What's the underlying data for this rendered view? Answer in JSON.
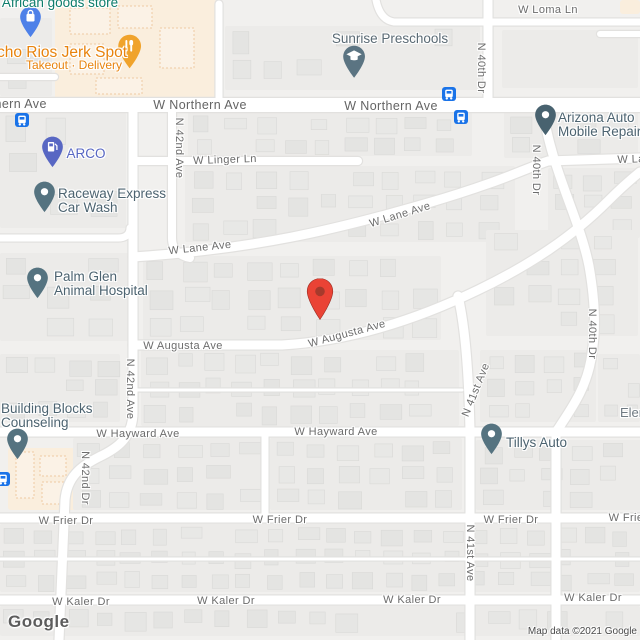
{
  "map": {
    "logo_text": "Google",
    "attribution": "Map data ©2021 Google",
    "colors": {
      "background": "#F1F0EE",
      "road": "#FFFFFF",
      "building": "#E6E6E4",
      "commercial_area": "#FAEEDD",
      "street_text": "#6C6C6C",
      "generic_poi_text": "#4C6370",
      "food_poi_text": "#E8830D",
      "shopping_poi_text": "#0E7D6B",
      "gas_poi_text": "#5867C3",
      "transit_blue": "#1A73E8",
      "marker_red": "#EA4335"
    },
    "marker": {
      "x": 320,
      "y": 299,
      "color": "#EA4335",
      "dot_color": "#A63A2C"
    },
    "transit_stops": [
      {
        "x": 22,
        "y": 120
      },
      {
        "x": 449,
        "y": 94
      },
      {
        "x": 461,
        "y": 117
      },
      {
        "x": 3,
        "y": 479
      }
    ],
    "street_labels": [
      {
        "text": "W Loma Ln",
        "x": 548,
        "y": 10
      },
      {
        "text": "W Northern Ave",
        "x": 0,
        "y": 104,
        "major": true
      },
      {
        "text": "W Northern Ave",
        "x": 200,
        "y": 105,
        "major": true
      },
      {
        "text": "W Northern Ave",
        "x": 391,
        "y": 106,
        "major": true
      },
      {
        "text": "W Linger Ln",
        "x": 225,
        "y": 160,
        "rot": -2
      },
      {
        "text": "W Lane Ave",
        "x": 200,
        "y": 248,
        "rot": -6
      },
      {
        "text": "W Lane Ave",
        "x": 400,
        "y": 215,
        "rot": -17
      },
      {
        "text": "W Lane Ave",
        "x": 649,
        "y": 159,
        "rot": -2
      },
      {
        "text": "W Augusta Ave",
        "x": 183,
        "y": 346
      },
      {
        "text": "W Augusta Ave",
        "x": 347,
        "y": 334,
        "rot": -15
      },
      {
        "text": "W Hayward Ave",
        "x": 138,
        "y": 434
      },
      {
        "text": "W Hayward Ave",
        "x": 336,
        "y": 432
      },
      {
        "text": "W Frier Dr",
        "x": 66,
        "y": 521
      },
      {
        "text": "W Frier Dr",
        "x": 280,
        "y": 520
      },
      {
        "text": "W Frier Dr",
        "x": 511,
        "y": 520
      },
      {
        "text": "W Frier Dr",
        "x": 636,
        "y": 518
      },
      {
        "text": "W Kaler Dr",
        "x": 81,
        "y": 602
      },
      {
        "text": "W Kaler Dr",
        "x": 226,
        "y": 601
      },
      {
        "text": "W Kaler Dr",
        "x": 412,
        "y": 600
      },
      {
        "text": "W Kaler Dr",
        "x": 593,
        "y": 598
      },
      {
        "text": "N 42nd Ave",
        "x": 179,
        "y": 148,
        "vert": true
      },
      {
        "text": "N 42nd Ave",
        "x": 130,
        "y": 389,
        "vert": true
      },
      {
        "text": "N 42nd Dr",
        "x": 85,
        "y": 478,
        "vert": true
      },
      {
        "text": "N 40th Dr",
        "x": 481,
        "y": 68,
        "vert": true
      },
      {
        "text": "N 40th Dr",
        "x": 536,
        "y": 170,
        "vert": true
      },
      {
        "text": "N 40th Dr",
        "x": 592,
        "y": 334,
        "vert": true
      },
      {
        "text": "N 41st Ave",
        "x": 476,
        "y": 390,
        "rot": -68
      },
      {
        "text": "N 41st Ave",
        "x": 470,
        "y": 553,
        "vert": true
      }
    ],
    "pois": [
      {
        "id": "african-goods-store",
        "lines": [
          "African goods store"
        ],
        "x": 60,
        "y": 2,
        "align": "center",
        "color": "#0E7D6B",
        "size": 13.5,
        "pin": {
          "x": 30,
          "y": 22,
          "color": "#4D80E8",
          "glyph": "bag"
        }
      },
      {
        "id": "ocho-rios-jerk-spot",
        "lines": [
          "Ocho Rios Jerk Spot"
        ],
        "x": 56,
        "y": 51,
        "align": "center",
        "color": "#E8830D",
        "size": 15.5,
        "sub": {
          "text": "Takeout · Delivery",
          "x": 74,
          "y": 64,
          "size": 12
        },
        "pin": {
          "x": 130,
          "y": 52,
          "color": "#F0A32C",
          "glyph": "food",
          "s": 1.1
        }
      },
      {
        "id": "sunrise-preschools",
        "lines": [
          "Sunrise Preschools"
        ],
        "x": 390,
        "y": 38,
        "align": "center",
        "color": "#5A6A74",
        "size": 13.5,
        "pin": {
          "x": 354,
          "y": 62,
          "color": "#5B7482",
          "glyph": "cap",
          "s": 1.05
        }
      },
      {
        "id": "arco",
        "lines": [
          "ARCO"
        ],
        "x": 86,
        "y": 153,
        "align": "center",
        "color": "#5867C3",
        "size": 13.5,
        "pin": {
          "x": 52,
          "y": 152,
          "color": "#5867C3",
          "glyph": "gas"
        }
      },
      {
        "id": "raceway-express-car-wash",
        "lines": [
          "Raceway Express",
          "Car Wash"
        ],
        "x": 58,
        "y": 193,
        "align": "left",
        "color": "#4C6370",
        "size": 13.5,
        "pin": {
          "x": 44,
          "y": 197,
          "color": "#557380",
          "glyph": "dot"
        }
      },
      {
        "id": "palm-glen-animal-hospital",
        "lines": [
          "Palm Glen",
          "Animal Hospital"
        ],
        "x": 54,
        "y": 276,
        "align": "left",
        "color": "#4C6370",
        "size": 13.5,
        "pin": {
          "x": 37,
          "y": 283,
          "color": "#557380",
          "glyph": "dot"
        }
      },
      {
        "id": "arizona-auto-mobile-repair",
        "lines": [
          "Arizona Auto",
          "Mobile Repair"
        ],
        "x": 558,
        "y": 117,
        "align": "left",
        "color": "#4C6370",
        "size": 13.5,
        "pin": {
          "x": 545,
          "y": 120,
          "color": "#48626F",
          "glyph": "dot"
        }
      },
      {
        "id": "building-blocks-counseling",
        "lines": [
          "Building Blocks",
          "Counseling"
        ],
        "x": 1,
        "y": 408,
        "align": "left",
        "color": "#4C6370",
        "size": 13.5,
        "pin": {
          "x": 17,
          "y": 444,
          "color": "#557380",
          "glyph": "dot"
        }
      },
      {
        "id": "tillys-auto",
        "lines": [
          "Tillys Auto"
        ],
        "x": 506,
        "y": 442,
        "align": "left",
        "color": "#4C6370",
        "size": 13.5,
        "pin": {
          "x": 491,
          "y": 439,
          "color": "#557380",
          "glyph": "dot"
        }
      },
      {
        "id": "elementary-clipped",
        "lines": [
          "Elementary"
        ],
        "x": 620,
        "y": 412,
        "align": "left",
        "color": "#6F7A82",
        "size": 13
      }
    ]
  }
}
